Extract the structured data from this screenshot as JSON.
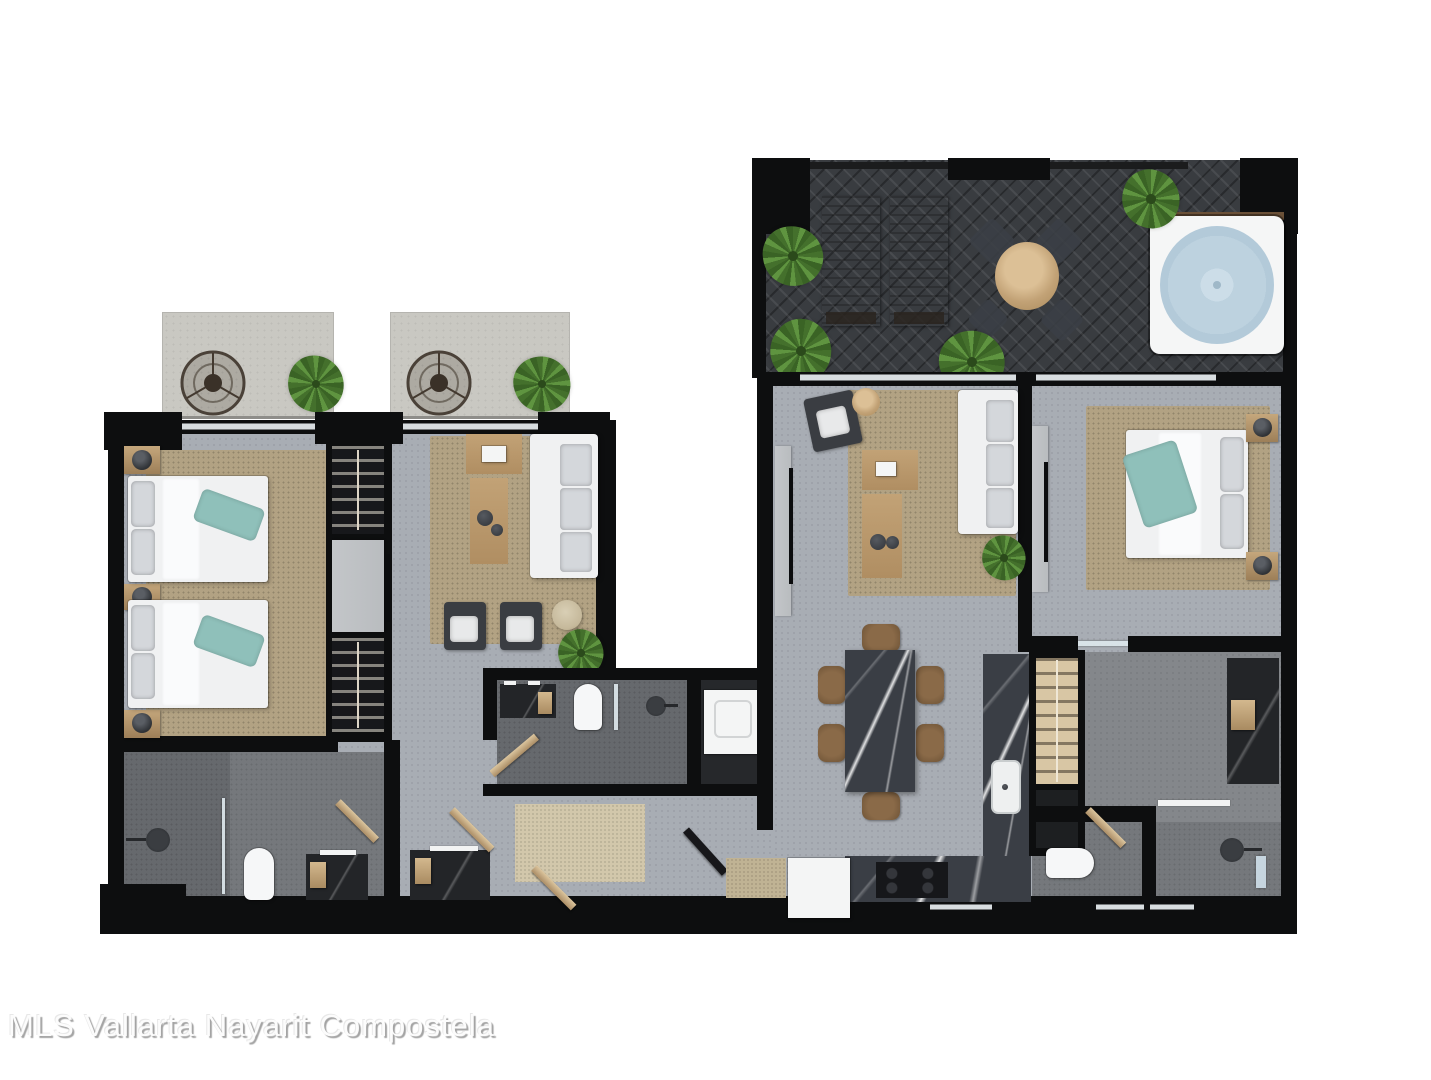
{
  "watermark": {
    "text": "MLS Vallarta Nayarit Compostela"
  },
  "colors": {
    "wall": "#0d0e0f",
    "floor-light": "#a8adb4",
    "bath-floor": "#75787c",
    "terrace-tile": "#393c40",
    "balcony-concrete": "#c9c8c2",
    "rug-jute": "#b2a283",
    "rug-runner": "#d2c7ab",
    "wood": "#c2a276",
    "teal-accent": "#8fc0ba",
    "sofa-white": "#f0f1f2",
    "cushion-gray": "#d4d7db",
    "marble-dark": "#3a3e45",
    "closet-beige": "#d8c6a4",
    "spa-water": "#b3cad9",
    "glass": "#dfe9ee",
    "console-gray": "#b9bcbf",
    "appliance-white": "#f4f5f5",
    "dark-counter": "#232528"
  }
}
